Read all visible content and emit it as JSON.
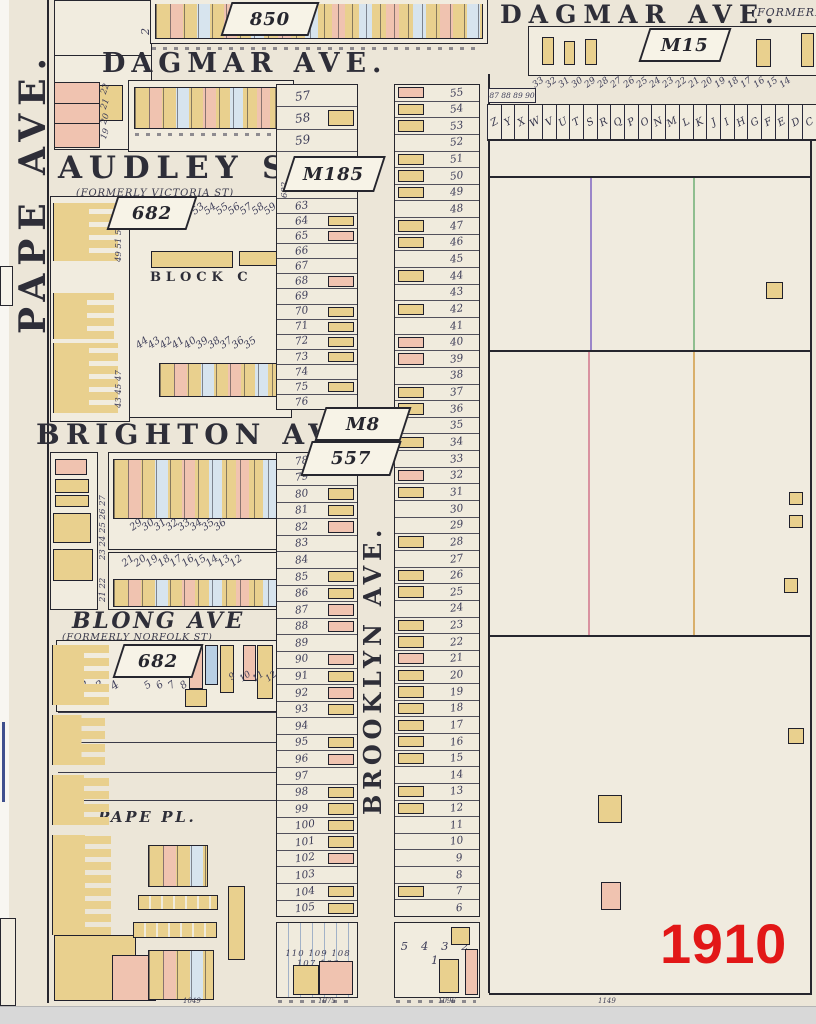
{
  "year": "1910",
  "palette": {
    "paper": "#ece6d8",
    "block": "#f1ecdf",
    "building_yellow": "#e9d08e",
    "building_pink": "#f0c3b0",
    "ink": "#26262e",
    "year_red": "#e21717",
    "line_blue": "#7fa8cf",
    "line_pink": "#d992a0",
    "line_green": "#8fbe8f",
    "line_orange": "#d9af6b",
    "line_purple": "#9b86c9",
    "scroll_gray": "#d8d8d8"
  },
  "streets": {
    "pape": "PAPE AVE.",
    "dagmar_left": "DAGMAR AVE.",
    "dagmar_right": "DAGMAR AVE.",
    "dagmar_right_note": "(FORMERLY",
    "audley": "AUDLEY ST.",
    "audley_note": "(FORMERLY VICTORIA ST)",
    "brighton": "BRIGHTON AVE.",
    "blong": "BLONG AVE",
    "blong_note": "(FORMERLY NORFOLK ST)",
    "brooklyn": "BROOKLYN AVE.",
    "pape_pl": "PAPE PL."
  },
  "plates": {
    "plan_850": "850",
    "plan_m185": "M185",
    "plan_m8": "M8",
    "plan_557": "557",
    "plan_682_audley": "682",
    "plan_682_blong": "682",
    "plan_m15": "M15"
  },
  "labels": {
    "block_c": "BLOCK C",
    "plan_ref_vertical": "682"
  },
  "west_lots_a": [
    {
      "n": "57",
      "b": ""
    },
    {
      "n": "58",
      "b": "y"
    },
    {
      "n": "59",
      "b": ""
    }
  ],
  "west_lots_b": [
    {
      "n": "63",
      "b": ""
    },
    {
      "n": "64",
      "b": "y"
    },
    {
      "n": "65",
      "b": "p"
    },
    {
      "n": "66",
      "b": ""
    },
    {
      "n": "67",
      "b": ""
    },
    {
      "n": "68",
      "b": "p"
    },
    {
      "n": "69",
      "b": ""
    },
    {
      "n": "70",
      "b": "y"
    },
    {
      "n": "71",
      "b": "y"
    },
    {
      "n": "72",
      "b": "y"
    },
    {
      "n": "73",
      "b": "y"
    },
    {
      "n": "74",
      "b": ""
    },
    {
      "n": "75",
      "b": "y"
    },
    {
      "n": "76",
      "b": ""
    }
  ],
  "west_lots_c": [
    {
      "n": "78",
      "b": ""
    },
    {
      "n": "79",
      "b": ""
    },
    {
      "n": "80",
      "b": "y"
    },
    {
      "n": "81",
      "b": "y"
    },
    {
      "n": "82",
      "b": "p"
    },
    {
      "n": "83",
      "b": ""
    },
    {
      "n": "84",
      "b": ""
    },
    {
      "n": "85",
      "b": "y"
    },
    {
      "n": "86",
      "b": "y"
    },
    {
      "n": "87",
      "b": "p"
    },
    {
      "n": "88",
      "b": "p"
    },
    {
      "n": "89",
      "b": ""
    },
    {
      "n": "90",
      "b": "p"
    },
    {
      "n": "91",
      "b": "y"
    },
    {
      "n": "92",
      "b": "p"
    },
    {
      "n": "93",
      "b": "y"
    },
    {
      "n": "94",
      "b": ""
    },
    {
      "n": "95",
      "b": "y"
    },
    {
      "n": "96",
      "b": "p"
    },
    {
      "n": "97",
      "b": ""
    },
    {
      "n": "98",
      "b": "y"
    },
    {
      "n": "99",
      "b": "y"
    },
    {
      "n": "100",
      "b": "y"
    },
    {
      "n": "101",
      "b": "y"
    },
    {
      "n": "102",
      "b": "p"
    },
    {
      "n": "103",
      "b": ""
    },
    {
      "n": "104",
      "b": "y"
    },
    {
      "n": "105",
      "b": "y"
    }
  ],
  "east_lots": [
    {
      "n": "55",
      "b": "p"
    },
    {
      "n": "54",
      "b": "y"
    },
    {
      "n": "53",
      "b": "y"
    },
    {
      "n": "52",
      "b": ""
    },
    {
      "n": "51",
      "b": "y"
    },
    {
      "n": "50",
      "b": "y"
    },
    {
      "n": "49",
      "b": "y"
    },
    {
      "n": "48",
      "b": ""
    },
    {
      "n": "47",
      "b": "y"
    },
    {
      "n": "46",
      "b": "y"
    },
    {
      "n": "45",
      "b": ""
    },
    {
      "n": "44",
      "b": "y"
    },
    {
      "n": "43",
      "b": ""
    },
    {
      "n": "42",
      "b": "y"
    },
    {
      "n": "41",
      "b": ""
    },
    {
      "n": "40",
      "b": "p"
    },
    {
      "n": "39",
      "b": "p"
    },
    {
      "n": "38",
      "b": ""
    },
    {
      "n": "37",
      "b": "y"
    },
    {
      "n": "36",
      "b": "y"
    },
    {
      "n": "35",
      "b": ""
    },
    {
      "n": "34",
      "b": "y"
    },
    {
      "n": "33",
      "b": ""
    },
    {
      "n": "32",
      "b": "p"
    },
    {
      "n": "31",
      "b": "y"
    },
    {
      "n": "30",
      "b": ""
    },
    {
      "n": "29",
      "b": ""
    },
    {
      "n": "28",
      "b": "y"
    },
    {
      "n": "27",
      "b": ""
    },
    {
      "n": "26",
      "b": "y"
    },
    {
      "n": "25",
      "b": "y"
    },
    {
      "n": "24",
      "b": ""
    },
    {
      "n": "23",
      "b": "y"
    },
    {
      "n": "22",
      "b": "y"
    },
    {
      "n": "21",
      "b": "p"
    },
    {
      "n": "20",
      "b": "y"
    },
    {
      "n": "19",
      "b": "y"
    },
    {
      "n": "18",
      "b": "y"
    },
    {
      "n": "17",
      "b": "y"
    },
    {
      "n": "16",
      "b": "y"
    },
    {
      "n": "15",
      "b": "y"
    },
    {
      "n": "14",
      "b": ""
    },
    {
      "n": "13",
      "b": "y"
    },
    {
      "n": "12",
      "b": "y"
    },
    {
      "n": "11",
      "b": ""
    },
    {
      "n": "10",
      "b": ""
    },
    {
      "n": "9",
      "b": ""
    },
    {
      "n": "8",
      "b": ""
    },
    {
      "n": "7",
      "b": "y"
    },
    {
      "n": "6",
      "b": ""
    }
  ],
  "west_bottom_row": "110 109 108 107 106",
  "east_bottom_row": "5 4 3 2 1",
  "letter_lots": [
    "Z",
    "Y",
    "X",
    "W",
    "V",
    "U",
    "T",
    "S",
    "R",
    "Q",
    "P",
    "O",
    "N",
    "M",
    "L",
    "K",
    "J",
    "I",
    "H",
    "G",
    "F",
    "E",
    "D",
    "C"
  ],
  "topright_lot_numbers": [
    "33",
    "32",
    "31",
    "30",
    "29",
    "28",
    "27",
    "26",
    "25",
    "24",
    "23",
    "22",
    "21",
    "20",
    "19",
    "18",
    "17",
    "16",
    "15",
    "14"
  ],
  "topright_house_numbers": "87 88 89 90",
  "audley_block": {
    "north_row": [
      "53",
      "54",
      "55",
      "56",
      "57",
      "58",
      "59",
      "60",
      "61",
      "62"
    ],
    "south_row": [
      "44",
      "43",
      "42",
      "41",
      "40",
      "39",
      "38",
      "37",
      "36",
      "35"
    ]
  },
  "brighton_block": {
    "north_row": [
      "29",
      "30",
      "31",
      "32",
      "33",
      "34",
      "35",
      "36"
    ],
    "south_row": [
      "21",
      "20",
      "19",
      "18",
      "17",
      "16",
      "15",
      "14",
      "13",
      "12"
    ]
  },
  "blong_block": {
    "west_row": [
      "1",
      "2",
      "3",
      "4"
    ],
    "east_row": [
      "5",
      "6",
      "7",
      "8"
    ],
    "east_row2": [
      "9",
      "10",
      "11",
      "12"
    ]
  },
  "pape_blocks": {
    "upper_lots": [
      "2",
      "3"
    ],
    "pink_numbers": [
      "22",
      "21",
      "20",
      "19"
    ],
    "audley_side": "49 51 53 55",
    "audley_side2": "43 45 47",
    "brighton_side": "23 24 25 26 27",
    "brighton_side2": "21 22"
  },
  "bottom_edge_numbers": [
    "1049",
    "1075",
    "1096",
    "1149"
  ]
}
